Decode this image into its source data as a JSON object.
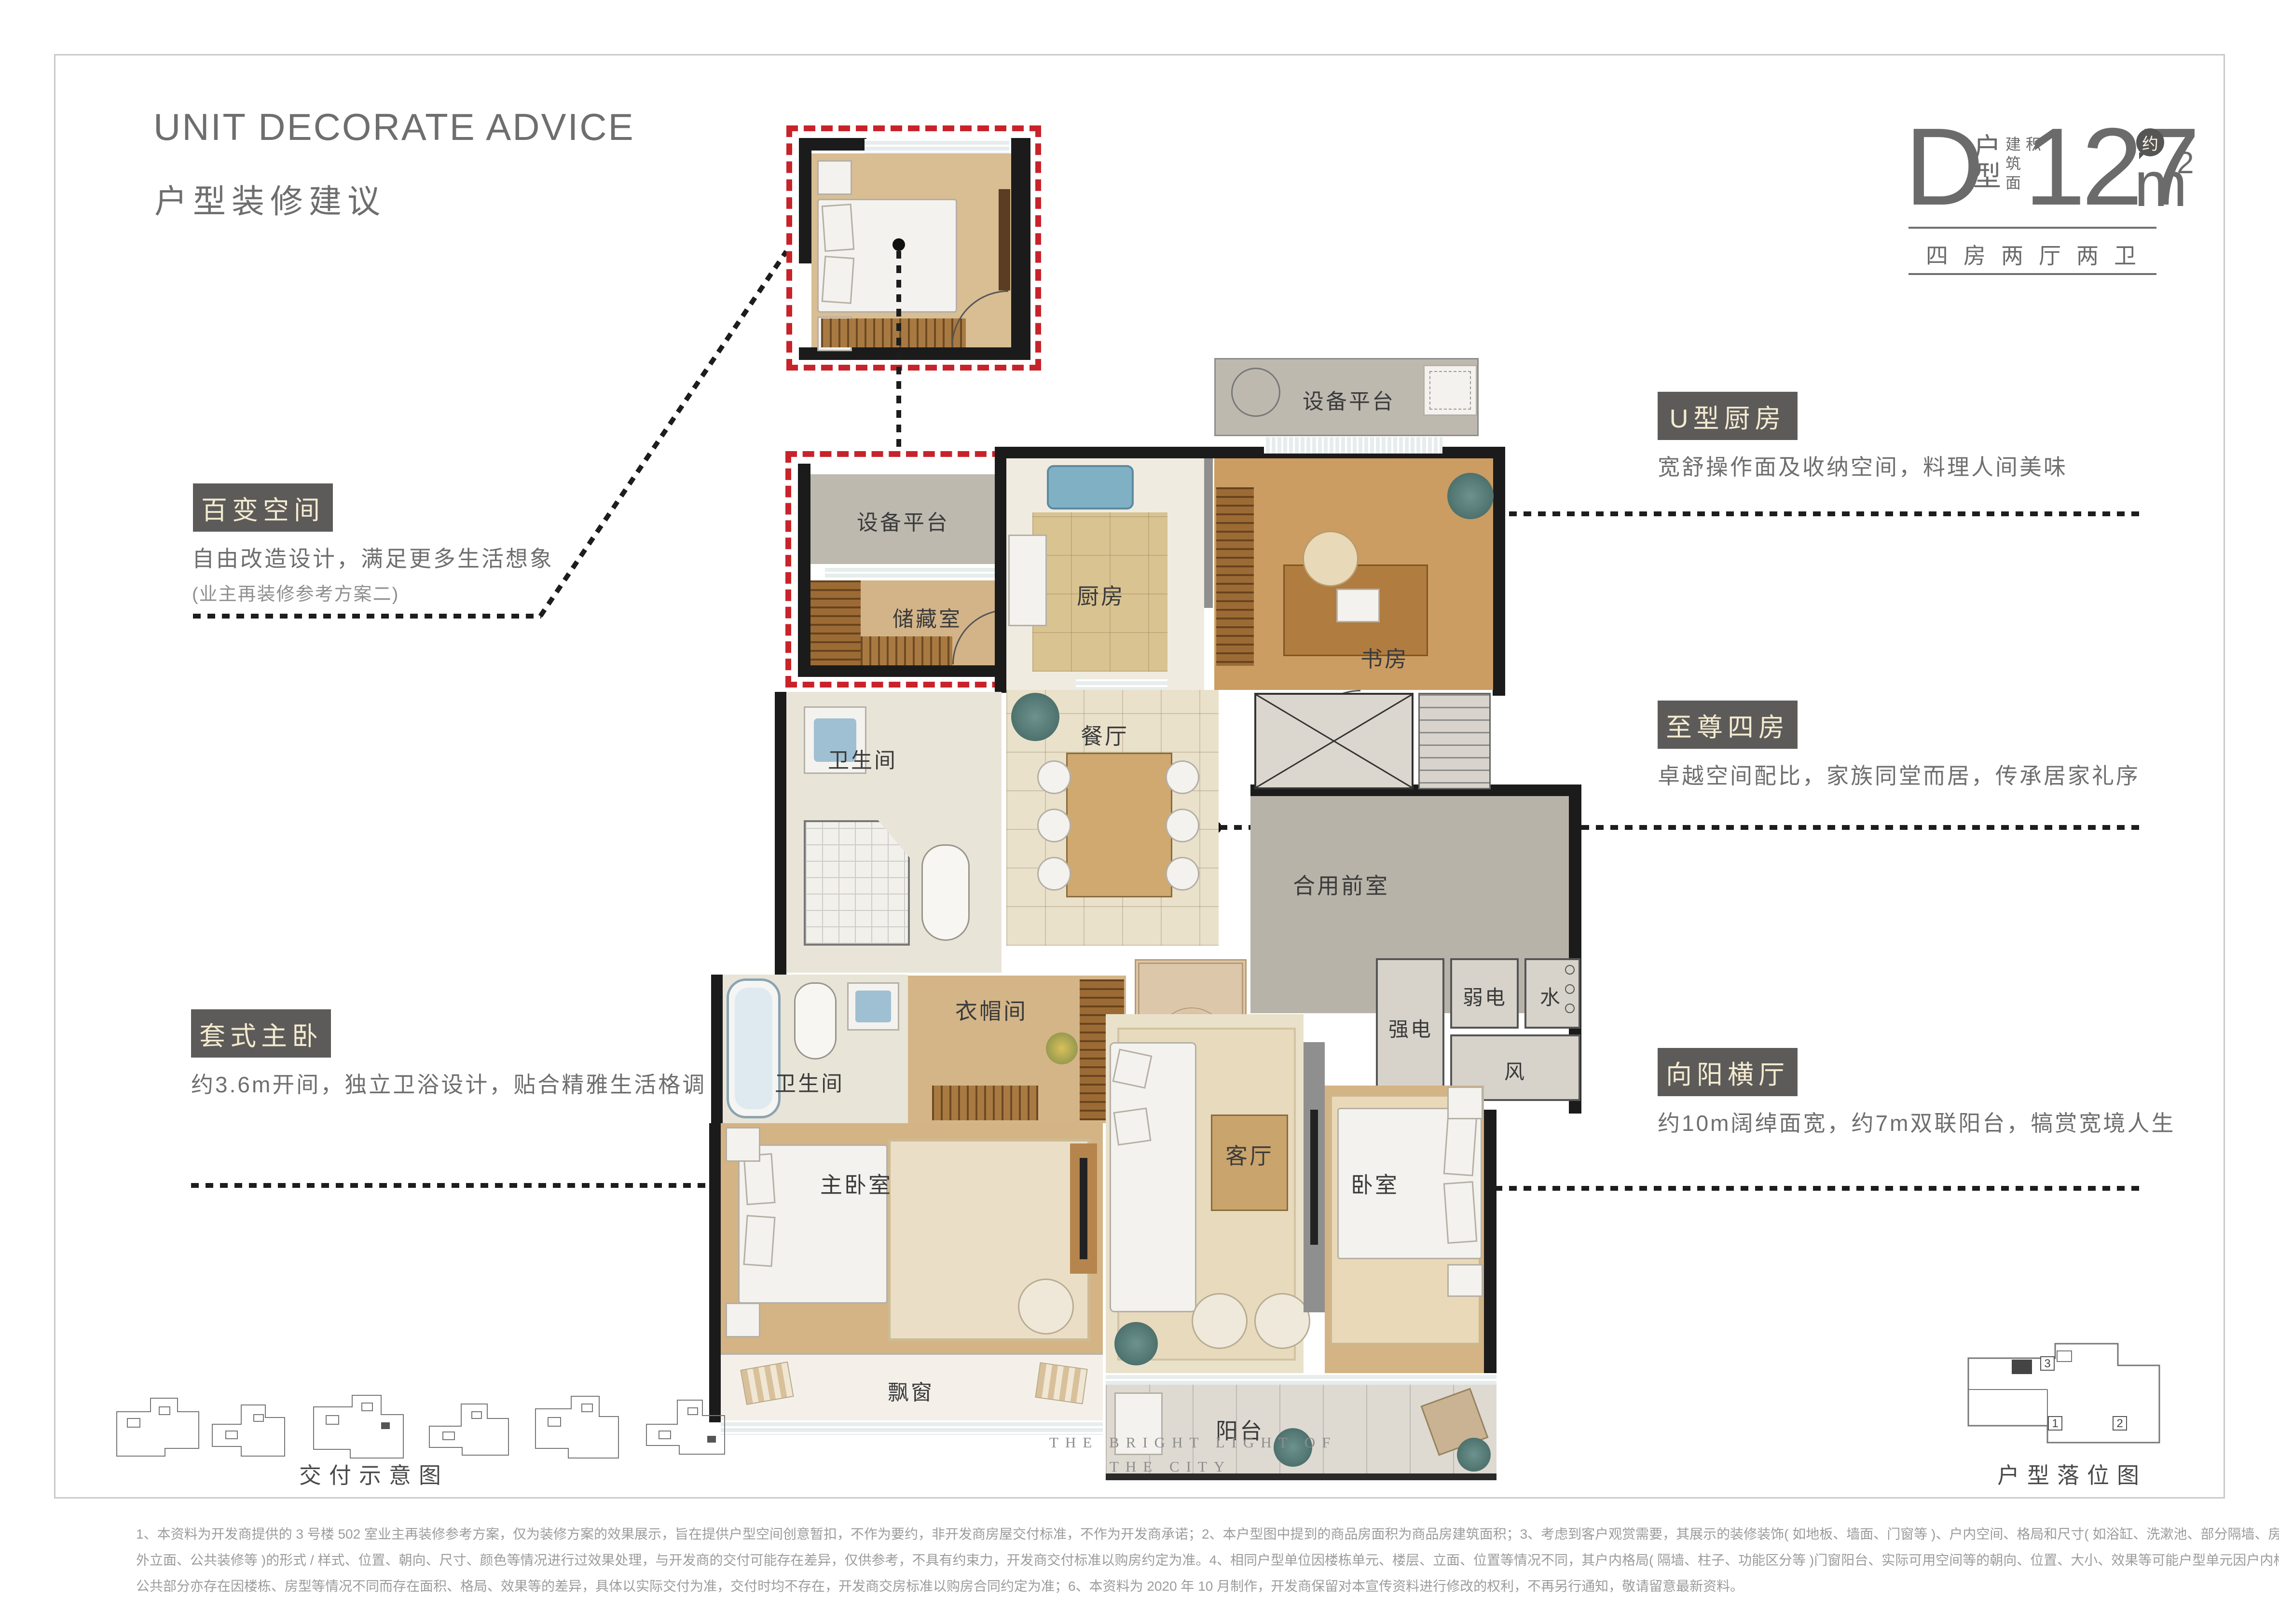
{
  "header": {
    "title_en": "UNIT DECORATE ADVICE",
    "title_cn": "户型装修建议"
  },
  "unit_info": {
    "type_letter": "D",
    "type_label": "户型",
    "area_label": "建筑面积",
    "approx_badge": "约",
    "area_value": "127",
    "area_unit": "m",
    "area_sup": "2",
    "layout": "四房两厅两卫"
  },
  "callouts": {
    "flex_space": {
      "title": "百变空间",
      "desc": "自由改造设计，满足更多生活想象",
      "note": "(业主再装修参考方案二)"
    },
    "u_kitchen": {
      "title": "U型厨房",
      "desc": "宽舒操作面及收纳空间，料理人间美味"
    },
    "four_rooms": {
      "title": "至尊四房",
      "desc": "卓越空间配比，家族同堂而居，传承居家礼序"
    },
    "master_suite": {
      "title": "套式主卧",
      "desc": "约3.6m开间，独立卫浴设计，贴合精雅生活格调"
    },
    "sunny_hall": {
      "title": "向阳横厅",
      "desc": "约10m阔绰面宽，约7m双联阳台，犒赏宽境人生"
    }
  },
  "rooms": {
    "equip_platform_inset": "设备平台",
    "storage": "储藏室",
    "equip_platform_top": "设备平台",
    "kitchen": "厨房",
    "study": "书房",
    "dining": "餐厅",
    "bath_upper": "卫生间",
    "bath_lower": "卫生间",
    "cloak": "衣帽间",
    "foyer": "玄关",
    "front_room": "合用前室",
    "strong_elec": "强电",
    "weak_elec": "弱电",
    "water": "水",
    "wind": "风",
    "master_bedroom": "主卧室",
    "living": "客厅",
    "bedroom": "卧室",
    "bay_window": "飘窗",
    "balcony": "阳台"
  },
  "footer": {
    "left_caption": "交付示意图",
    "right_caption": "户型落位图",
    "motto_line1": "THE BRIGHT LIGHT OF",
    "motto_line2": "THE CITY",
    "locator_units": [
      "1",
      "2",
      "3"
    ],
    "disclaimer_line1": "1、本资料为开发商提供的 3 号楼 502 室业主再装修参考方案，仅为装修方案的效果展示，旨在提供户型空间创意暂扣，不作为要约，非开发商房屋交付标准，不作为开发商承诺；2、本户型图中提到的商品房面积为商品房建筑面积；3、考虑到客户观赏需要，其展示的装修装饰( 如地板、墙面、门窗等 )、户内空间、格局和尺寸( 如浴缸、洗漱池、部分隔墙、房间、阳台等 )、公共区域( 如景观、楼道、",
    "disclaimer_line2": "外立面、公共装修等 )的形式 / 样式、位置、朝向、尺寸、颜色等情况进行过效果处理，与开发商的交付可能存在差异，仅供参考，不具有约束力，开发商交付标准以购房约定为准。4、相同户型单位因楼栋单元、楼层、立面、位置等情况不同，其户内格局( 隔墙、柱子、功能区分等 )门窗阳台、实际可用空间等的朝向、位置、大小、效果等可能户型单元因户内格局、面积等情况不同，不具备对照参考性；",
    "disclaimer_line3": "公共部分亦存在因楼栋、房型等情况不同而存在面积、格局、效果等的差异，具体以实际交付为准，交付时均不存在，开发商交房标准以购房合同约定为准；6、本资料为 2020 年 10 月制作，开发商保留对本宣传资料进行修改的权利，不再另行通知，敬请留意最新资料。"
  },
  "colors": {
    "accent_red": "#c8232a",
    "tag_box_bg": "#5c5b59",
    "tag_box_text": "#f3ead0",
    "title_gray": "#6e6e6e"
  }
}
